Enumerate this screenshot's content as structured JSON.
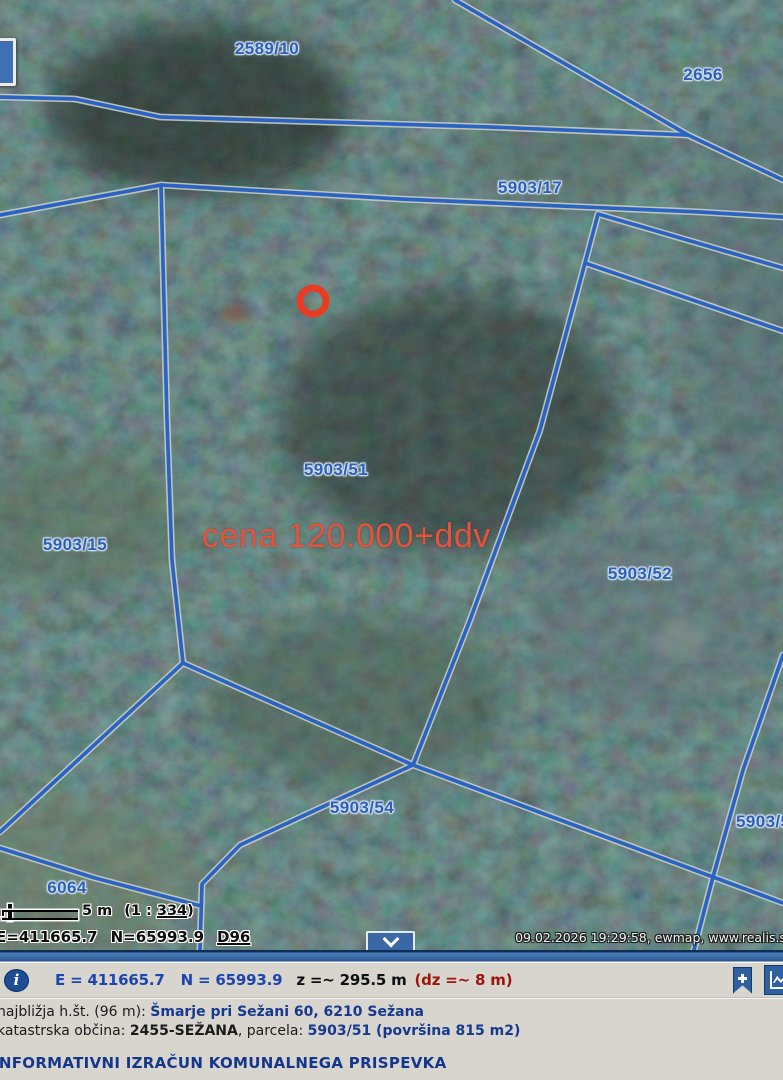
{
  "map": {
    "parcel_labels": [
      {
        "text": "2589/10"
      },
      {
        "text": "2656"
      },
      {
        "text": "5903/17"
      },
      {
        "text": "5903/51"
      },
      {
        "text": "5903/15"
      },
      {
        "text": "5903/52"
      },
      {
        "text": "5903/54"
      },
      {
        "text": "5903/5"
      },
      {
        "text": "6064"
      }
    ],
    "annotation": {
      "price_text": "cena 120.000+ddv"
    },
    "scalebar": {
      "distance_label": "5 m",
      "ratio_prefix": "(1 : ",
      "ratio_value": "334",
      "ratio_suffix": ")"
    },
    "coords_overlay": {
      "e": "E=411665.7",
      "n": "N=65993.9",
      "datum": "D96"
    },
    "credit": "09.02.2026 19:29:58, ewmap, www.realis.s"
  },
  "statusbar": {
    "info_glyph": "i",
    "e_label": "E = 411665.7",
    "n_label": "N = 65993.9",
    "z_label": "z =~ 295.5 m",
    "dz_label": "(dz =~ 8 m)"
  },
  "info_panel": {
    "row1_label": "najbližja h.št. (96 m): ",
    "row1_value": "Šmarje pri Sežani 60, 6210 Sežana",
    "row2_label": "katastrska občina: ",
    "row2_bold": "2455-SEŽANA",
    "row2_mid": ", parcela: ",
    "row2_value": "5903/51 (površina 815 m2)",
    "link": "INFORMATIVNI IZRAČUN KOMUNALNEGA PRISPEVKA"
  },
  "icons": {
    "info-icon": "circled letter i",
    "bookmark-add-icon": "blue bookmark with plus",
    "height-profile-icon": "blue square with chart axis",
    "chevron-down-icon": "white chevron pointing down"
  },
  "colors": {
    "boundary_blue": "#2b63c3",
    "boundary_casing": "#c9cfc7",
    "label_blue": "#2e5fb4",
    "marker_red": "#e83b26",
    "price_red": "#e4543c",
    "panel_bg": "#d8d5cf",
    "bar_blue": "#34639f",
    "coord_blue": "#1c45b0",
    "dz_red": "#9c150c",
    "link_navy": "#14368c"
  }
}
